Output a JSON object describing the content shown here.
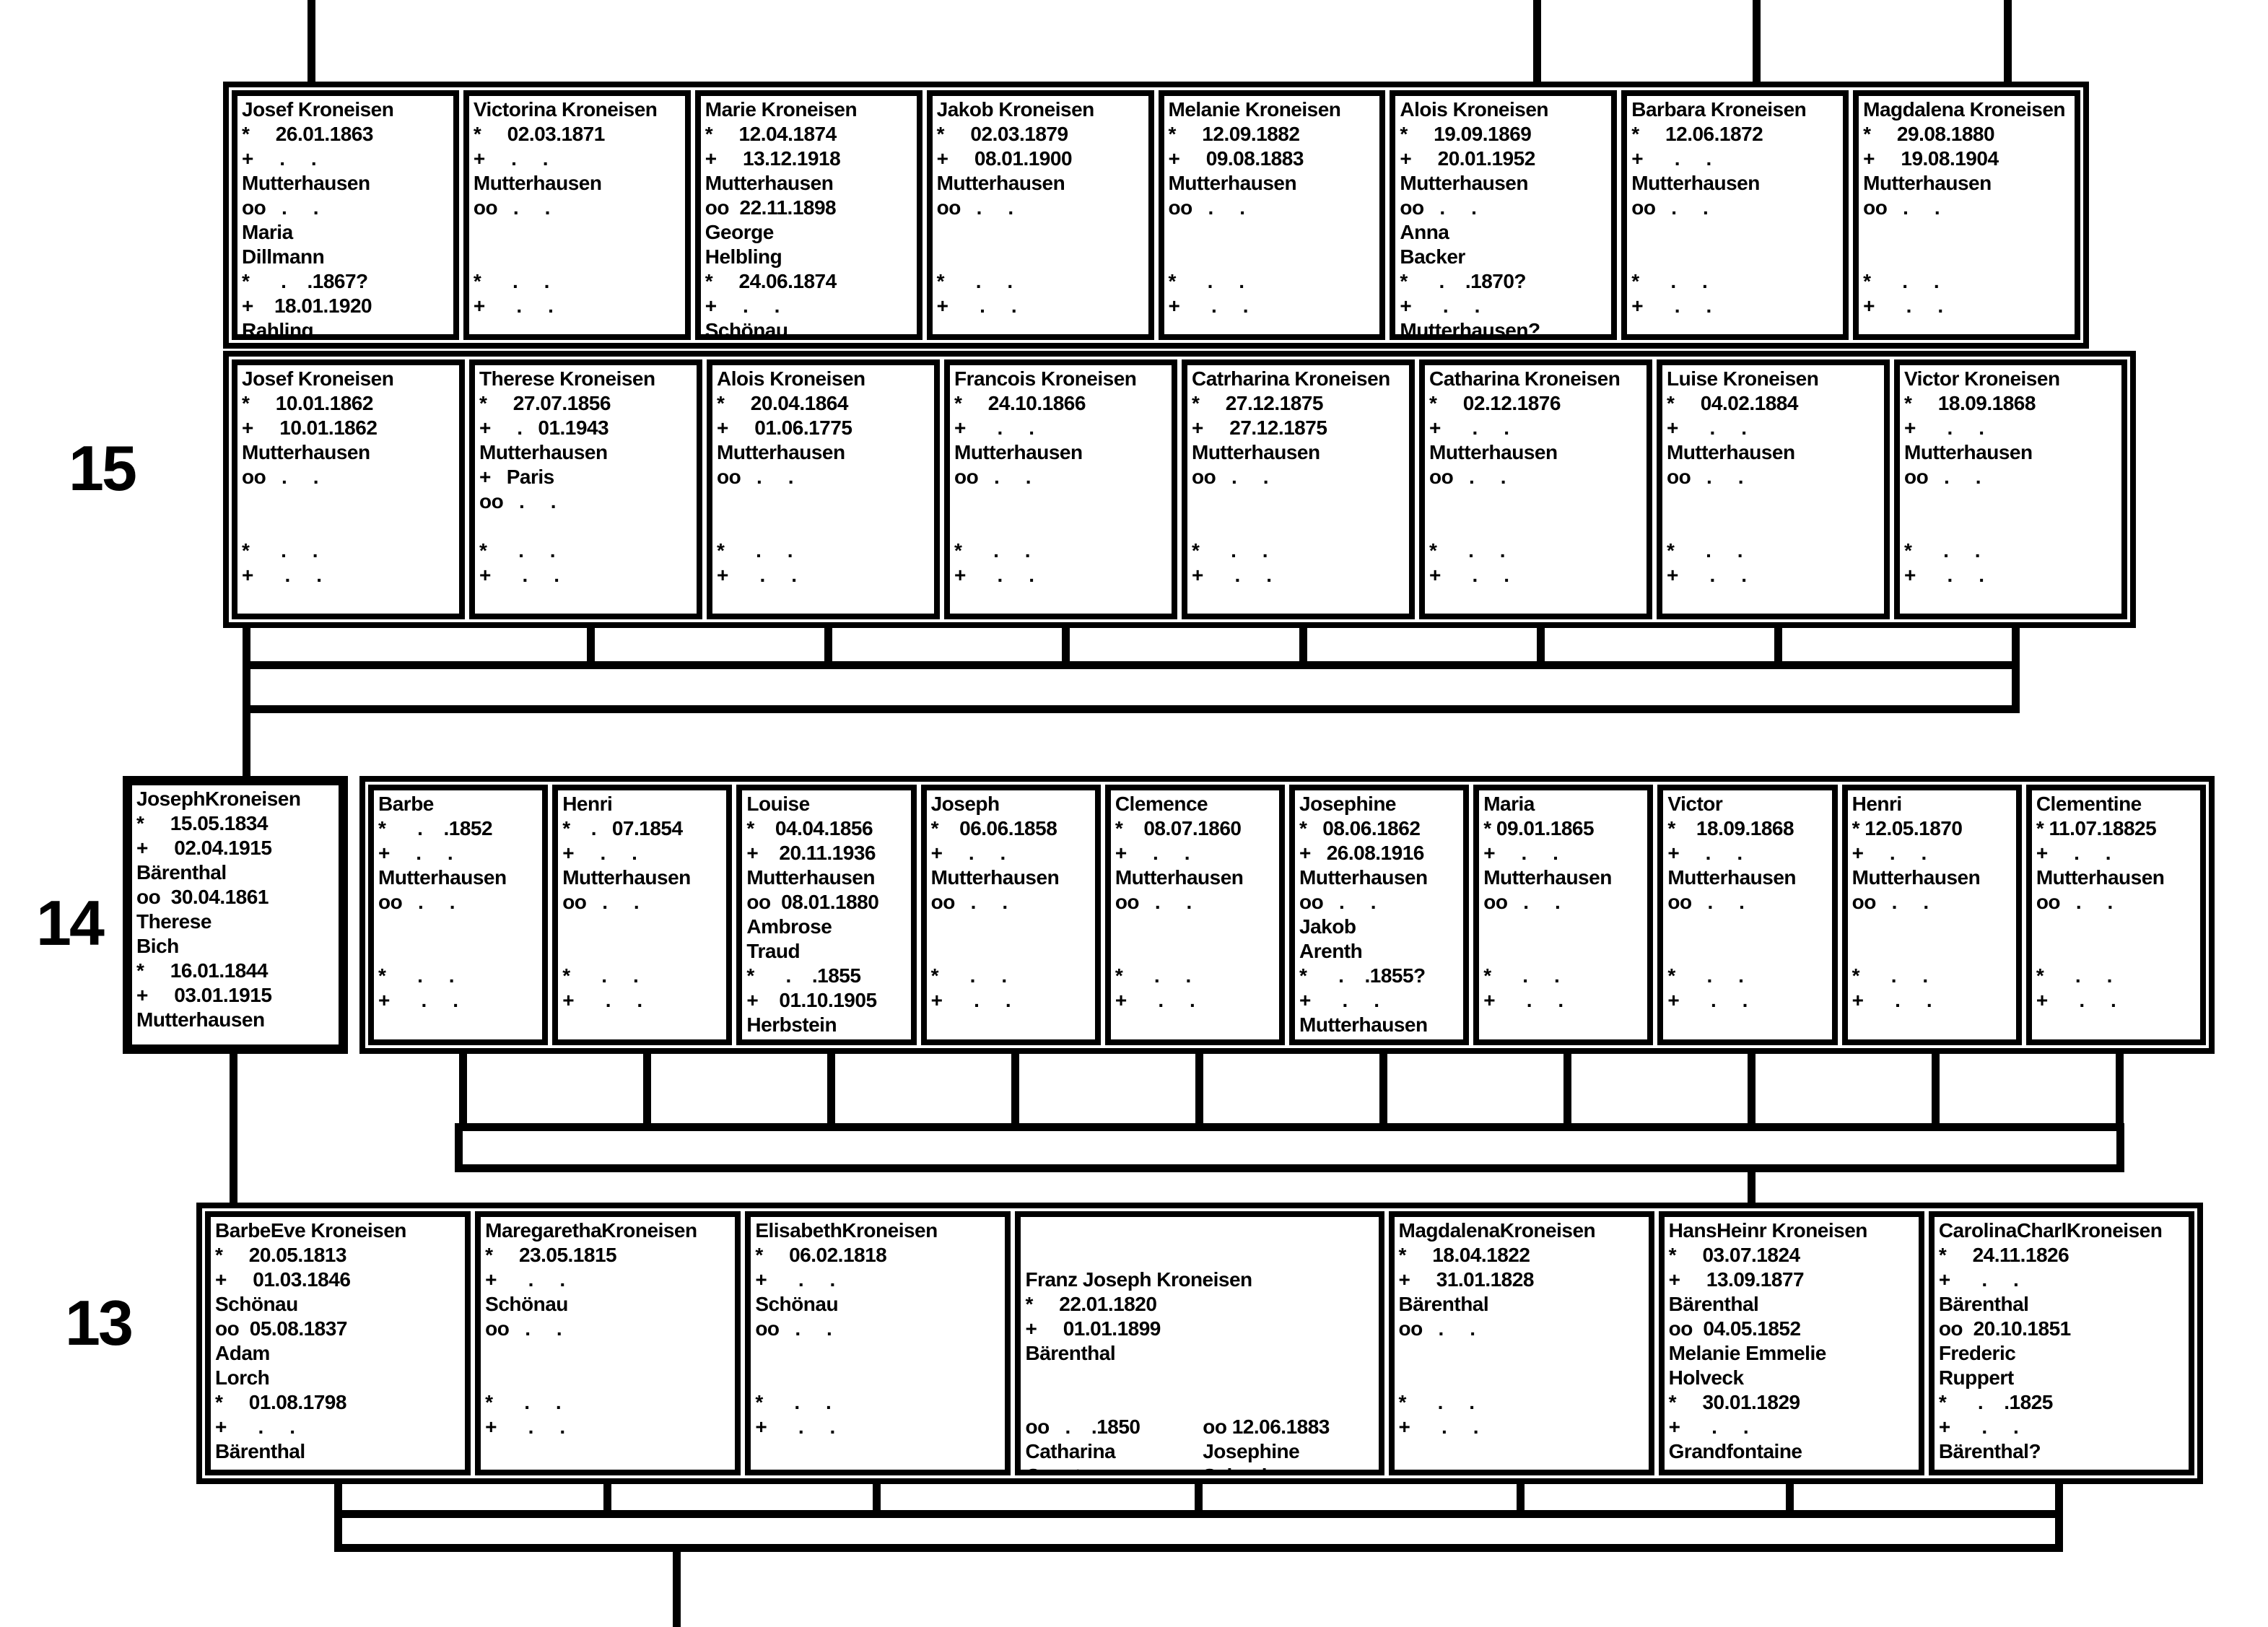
{
  "chart": {
    "generation_labels": [
      "15",
      "14",
      "13"
    ],
    "g15r1": [
      [
        "Josef Kroneisen",
        "*     26.01.1863",
        "+     .     .",
        "Mutterhausen",
        "oo   .     .",
        "Maria",
        "Dillmann",
        "*      .    .1867?",
        "+    18.01.1920",
        "Rahling"
      ],
      [
        "Victorina Kroneisen",
        "*     02.03.1871",
        "+     .     .",
        "Mutterhausen",
        "oo   .     .",
        "",
        "",
        "*      .     .",
        "+      .     .",
        ""
      ],
      [
        "Marie Kroneisen",
        "*     12.04.1874",
        "+     13.12.1918",
        "Mutterhausen",
        "oo  22.11.1898",
        "George",
        "Helbling",
        "*     24.06.1874",
        "+     .     .",
        "Schönau"
      ],
      [
        "Jakob Kroneisen",
        "*     02.03.1879",
        "+     08.01.1900",
        "Mutterhausen",
        "oo   .     .",
        "",
        "",
        "*      .     .",
        "+      .     .",
        ""
      ],
      [
        "Melanie Kroneisen",
        "*     12.09.1882",
        "+     09.08.1883",
        "Mutterhausen",
        "oo   .     .",
        "",
        "",
        "*      .     .",
        "+      .     .",
        ""
      ],
      [
        "Alois Kroneisen",
        "*     19.09.1869",
        "+     20.01.1952",
        "Mutterhausen",
        "oo   .     .",
        "Anna",
        "Backer",
        "*      .    .1870?",
        "+      .     .",
        "Mutterhausen?"
      ],
      [
        "Barbara Kroneisen",
        "*     12.06.1872",
        "+      .     .",
        "Mutterhausen",
        "oo   .     .",
        "",
        "",
        "*      .     .",
        "+      .     .",
        ""
      ],
      [
        "Magdalena Kroneisen",
        "*     29.08.1880",
        "+     19.08.1904",
        "Mutterhausen",
        "oo   .     .",
        "",
        "",
        "*      .     .",
        "+      .     .",
        ""
      ]
    ],
    "g15r2": [
      [
        "Josef Kroneisen",
        "*     10.01.1862",
        "+     10.01.1862",
        "Mutterhausen",
        "oo   .     .",
        "",
        "",
        "*      .     .",
        "+      .     ."
      ],
      [
        "Therese Kroneisen",
        "*     27.07.1856",
        "+     .   01.1943",
        "Mutterhausen",
        "+   Paris",
        "oo   .     .",
        "",
        "*      .     .",
        "+      .     ."
      ],
      [
        "Alois Kroneisen",
        "*     20.04.1864",
        "+     01.06.1775",
        "Mutterhausen",
        "oo   .     .",
        "",
        "",
        "*      .     .",
        "+      .     ."
      ],
      [
        "Francois Kroneisen",
        "*     24.10.1866",
        "+      .     .",
        "Mutterhausen",
        "oo   .     .",
        "",
        "",
        "*      .     .",
        "+      .     ."
      ],
      [
        "Catrharina Kroneisen",
        "*     27.12.1875",
        "+     27.12.1875",
        "Mutterhausen",
        "oo   .     .",
        "",
        "",
        "*      .     .",
        "+      .     ."
      ],
      [
        "Catharina Kroneisen",
        "*     02.12.1876",
        "+      .     .",
        "Mutterhausen",
        "oo   .     .",
        "",
        "",
        "*      .     .",
        "+      .     ."
      ],
      [
        "Luise Kroneisen",
        "*     04.02.1884",
        "+      .     .",
        "Mutterhausen",
        "oo   .     .",
        "",
        "",
        "*      .     .",
        "+      .     ."
      ],
      [
        "Victor Kroneisen",
        "*     18.09.1868",
        "+      .     .",
        "Mutterhausen",
        "oo   .     .",
        "",
        "",
        "*      .     .",
        "+      .     ."
      ]
    ],
    "g14p": [
      "JosephKroneisen",
      "*     15.05.1834",
      "+     02.04.1915",
      "Bärenthal",
      "oo  30.04.1861",
      "Therese",
      "Bich",
      "*     16.01.1844",
      "+     03.01.1915",
      "Mutterhausen"
    ],
    "g14c": [
      [
        "Barbe",
        "*      .    .1852",
        "+     .     .",
        "Mutterhausen",
        "oo   .     .",
        "",
        "",
        "*      .     .",
        "+      .     ."
      ],
      [
        "Henri",
        "*    .   07.1854",
        "+     .     .",
        "Mutterhausen",
        "oo   .     .",
        "",
        "",
        "*      .     .",
        "+      .     ."
      ],
      [
        "Louise",
        "*    04.04.1856",
        "+    20.11.1936",
        "Mutterhausen",
        "oo  08.01.1880",
        "Ambrose",
        "Traud",
        "*      .    .1855",
        "+    01.10.1905",
        "Herbstein"
      ],
      [
        "Joseph",
        "*    06.06.1858",
        "+     .     .",
        "Mutterhausen",
        "oo   .     .",
        "",
        "",
        "*      .     .",
        "+      .     ."
      ],
      [
        "Clemence",
        "*    08.07.1860",
        "+     .     .",
        "Mutterhausen",
        "oo   .     .",
        "",
        "",
        "*      .     .",
        "+      .     ."
      ],
      [
        "Josephine",
        "*   08.06.1862",
        "+   26.08.1916",
        "Mutterhausen",
        "oo   .     .",
        "Jakob",
        "Arenth",
        "*      .    .1855?",
        "+      .     .",
        "Mutterhausen"
      ],
      [
        "Maria",
        "* 09.01.1865",
        "+     .     .",
        "Mutterhausen",
        "oo   .     .",
        "",
        "",
        "*      .     .",
        "+      .     ."
      ],
      [
        "Victor",
        "*    18.09.1868",
        "+     .     .",
        "Mutterhausen",
        "oo   .     .",
        "",
        "",
        "*      .     .",
        "+      .     ."
      ],
      [
        "Henri",
        "* 12.05.1870",
        "+     .     .",
        "Mutterhausen",
        "oo   .     .",
        "",
        "",
        "*      .     .",
        "+      .     ."
      ],
      [
        "Clementine",
        "* 11.07.18825",
        "+     .     .",
        "Mutterhausen",
        "oo   .     .",
        "",
        "",
        "*      .     .",
        "+      .     ."
      ]
    ],
    "g13": [
      [
        "BarbeEve Kroneisen",
        "*     20.05.1813",
        "+     01.03.1846",
        "Schönau",
        "oo  05.08.1837",
        "Adam",
        "Lorch",
        "*     01.08.1798",
        "+      .     .",
        "Bärenthal"
      ],
      [
        "MaregarethaKroneisen",
        "*     23.05.1815",
        "+      .     .",
        "Schönau",
        "oo   .     .",
        "",
        "",
        "*      .     .",
        "+      .     .",
        ""
      ],
      [
        "ElisabethKroneisen",
        "*     06.02.1818",
        "+      .     .",
        "Schönau",
        "oo   .     .",
        "",
        "",
        "*      .     .",
        "+      .     .",
        ""
      ],
      {
        "head": [
          "Franz Joseph Kroneisen",
          "*     22.01.1820",
          "+     01.01.1899",
          "Bärenthal"
        ],
        "left": [
          "oo   .    .1850",
          "Catharina",
          "Ganster",
          "*      .    .1825?",
          "+      .     .",
          "Pfalz"
        ],
        "right": [
          "oo 12.06.1883",
          "Josephine",
          "Schenk",
          "*    .   .1826?",
          "+ 07.04.1906",
          "Allentown,PA,USA"
        ]
      },
      [
        "MagdalenaKroneisen",
        "*     18.04.1822",
        "+     31.01.1828",
        "Bärenthal",
        "oo   .     .",
        "",
        "",
        "*      .     .",
        "+      .     .",
        ""
      ],
      [
        "HansHeinr Kroneisen",
        "*     03.07.1824",
        "+     13.09.1877",
        "Bärenthal",
        "oo  04.05.1852",
        "Melanie Emmelie",
        "Holveck",
        "*     30.01.1829",
        "+      .     .",
        "Grandfontaine"
      ],
      [
        "CarolinaCharlKroneisen",
        "*     24.11.1826",
        "+      .     .",
        "Bärenthal",
        "oo  20.10.1851",
        "Frederic",
        "Ruppert",
        "*      .    .1825",
        "+      .     .",
        "Bärenthal?"
      ]
    ]
  }
}
